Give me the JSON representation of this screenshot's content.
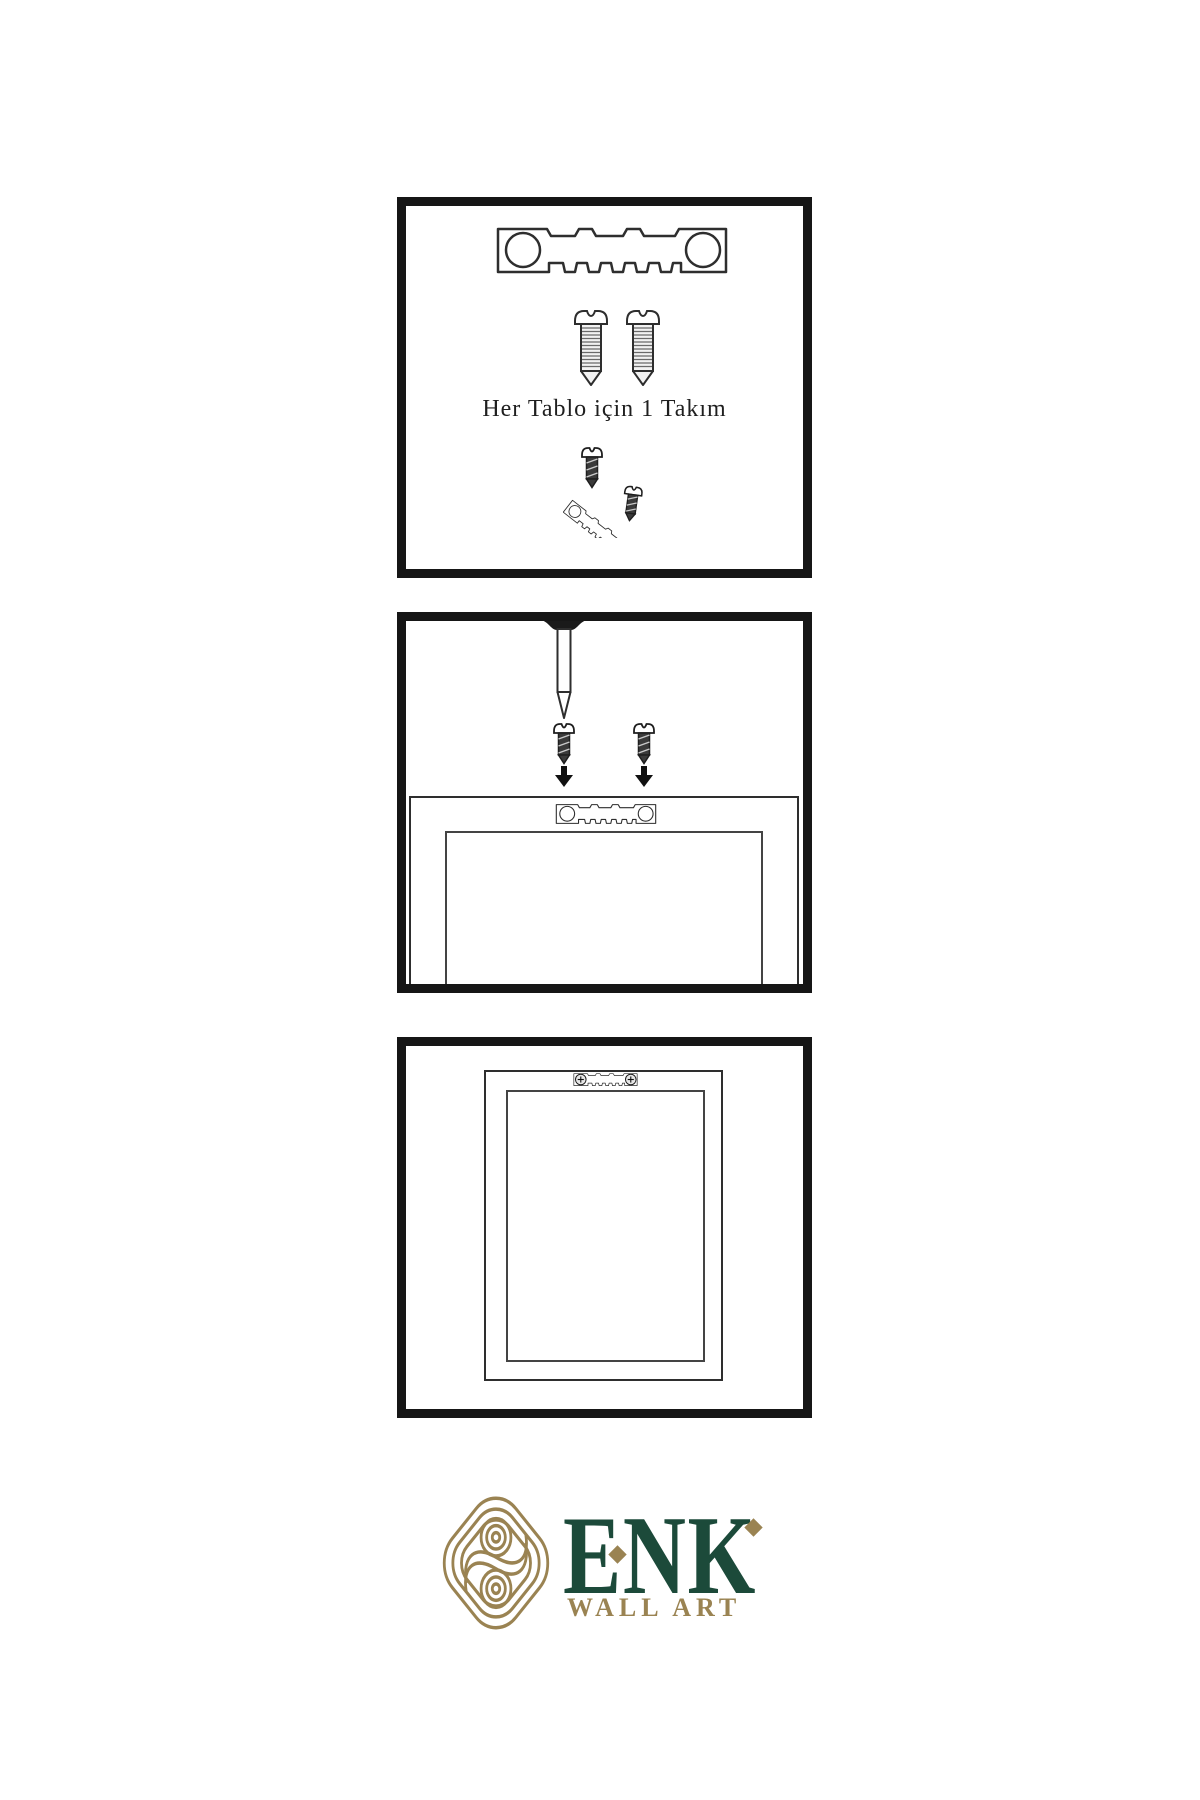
{
  "page": {
    "width": 1200,
    "height": 1800,
    "background": "#ffffff"
  },
  "instruction": {
    "text": "Her Tablo için 1 Takım"
  },
  "brand": {
    "name": "ENK",
    "tagline": "WALL ART"
  },
  "colors": {
    "artwork_line": "#2e2e2e",
    "panel_border": "#161616",
    "brand_green": "#1c4a3a",
    "brand_gold": "#9a8352",
    "screw_dark": "#3a3a3a"
  },
  "icons": {
    "panel_1": [
      "sawtooth-hanger-icon",
      "screw-icon",
      "screw-icon",
      "screw-into-tilted-hanger-icon"
    ],
    "panel_2": [
      "wall-nail-icon",
      "dark-screw-icon",
      "dark-screw-icon",
      "down-arrow-icon",
      "down-arrow-icon",
      "frame-back-with-hanger-icon"
    ],
    "panel_3": [
      "hung-frame-front-with-hanger-icon"
    ],
    "logo": [
      "knot-logo-icon"
    ]
  }
}
